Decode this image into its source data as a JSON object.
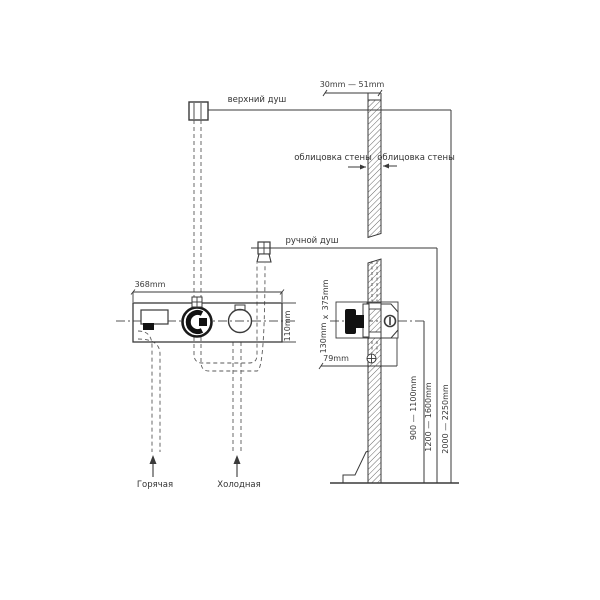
{
  "drawing": {
    "labels": {
      "upper_shower": "верхний душ",
      "hand_shower": "ручной душ",
      "wall_cladding_left": "облицовка стены",
      "wall_cladding_right": "облицовка стены",
      "hot_supply": "Горячая",
      "cold_supply": "Холодная"
    },
    "dimensions": {
      "wall_thickness": "30mm — 51mm",
      "panel_width": "368mm",
      "panel_height": "110mm",
      "recess_height": "375mm",
      "recess_times": "x",
      "recess_width": "130mm",
      "recess_depth": "79mm",
      "mixer_height": "900 — 1100mm",
      "hand_shower_height": "1200 — 1600mm",
      "upper_shower_height": "2000 — 2250mm"
    },
    "colors": {
      "line": "#3a3a3a",
      "pipe_dash": "#5a5a5a",
      "background": "#ffffff"
    }
  }
}
